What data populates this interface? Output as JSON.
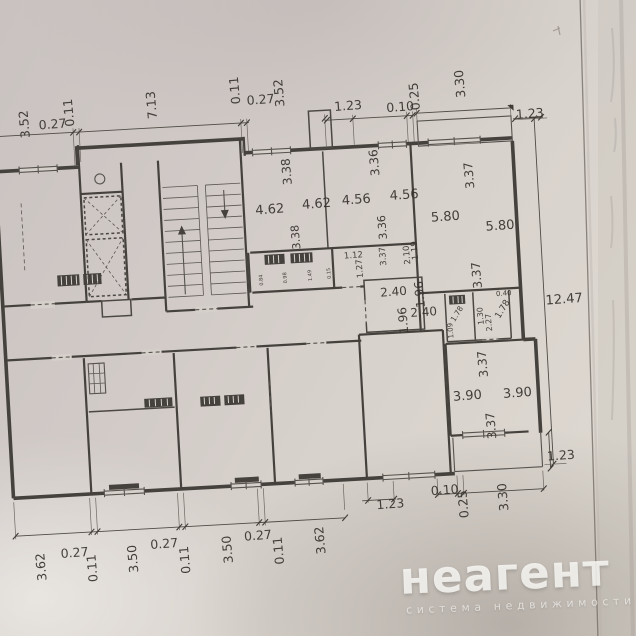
{
  "watermark": {
    "brand": "неагент",
    "tagline": "система недвижимости"
  },
  "colors": {
    "paper_top": "#c9c2c0",
    "paper_mid": "#d8d2cc",
    "paper_bottom": "#dfdad2",
    "ink": "#45413c",
    "label_ink": "#37332e",
    "watermark": "#fbfaf7",
    "paper_edge_line": "#756e68"
  },
  "plan": {
    "dimension_labels": [
      {
        "t": "3.52",
        "x": 40,
        "y": 119,
        "r": "v",
        "s": 12.5
      },
      {
        "t": "0.27",
        "x": 64,
        "y": 125,
        "r": "h",
        "s": 12.5
      },
      {
        "t": "0.11",
        "x": 85,
        "y": 110,
        "r": "v",
        "s": 12.5
      },
      {
        "t": "7.13",
        "x": 168,
        "y": 107,
        "r": "v",
        "s": 12.5
      },
      {
        "t": "0.11",
        "x": 252,
        "y": 97,
        "r": "v",
        "s": 12.5
      },
      {
        "t": "0.27",
        "x": 273,
        "y": 112,
        "r": "h",
        "s": 12.5
      },
      {
        "t": "3.52",
        "x": 296,
        "y": 102,
        "r": "v",
        "s": 12.5
      },
      {
        "t": "1.23",
        "x": 360,
        "y": 123,
        "r": "h",
        "s": 12.5
      },
      {
        "t": "0.10",
        "x": 412,
        "y": 127,
        "r": "h",
        "s": 12.5
      },
      {
        "t": "0.25",
        "x": 431,
        "y": 113,
        "r": "v",
        "s": 12.5
      },
      {
        "t": "3.30",
        "x": 477,
        "y": 103,
        "r": "v",
        "s": 12.5
      },
      {
        "t": "1.23",
        "x": 541,
        "y": 141,
        "r": "h",
        "s": 12.5
      },
      {
        "t": "12.47",
        "x": 565,
        "y": 328,
        "r": "h",
        "s": 13
      },
      {
        "t": "3.38",
        "x": 299,
        "y": 181,
        "r": "v",
        "s": 12
      },
      {
        "t": "4.62",
        "x": 276,
        "y": 222,
        "r": "h",
        "s": 13
      },
      {
        "t": "4.62",
        "x": 323,
        "y": 219,
        "r": "h",
        "s": 13
      },
      {
        "t": "3.38",
        "x": 304,
        "y": 247,
        "r": "v",
        "s": 11
      },
      {
        "t": "3.36",
        "x": 387,
        "y": 177,
        "r": "v",
        "s": 12
      },
      {
        "t": "4.56",
        "x": 363,
        "y": 217,
        "r": "h",
        "s": 13
      },
      {
        "t": "4.56",
        "x": 411,
        "y": 215,
        "r": "h",
        "s": 13
      },
      {
        "t": "3.36",
        "x": 391,
        "y": 242,
        "r": "v",
        "s": 11
      },
      {
        "t": "3.37",
        "x": 481,
        "y": 195,
        "r": "v",
        "s": 12
      },
      {
        "t": "5.80",
        "x": 451,
        "y": 239,
        "r": "h",
        "s": 13
      },
      {
        "t": "5.80",
        "x": 505,
        "y": 251,
        "r": "h",
        "s": 13
      },
      {
        "t": "3.37",
        "x": 483,
        "y": 295,
        "r": "v",
        "s": 12
      },
      {
        "t": "3.37",
        "x": 389,
        "y": 271,
        "r": "v",
        "s": 8.5
      },
      {
        "t": "1.12",
        "x": 357,
        "y": 271,
        "r": "h",
        "s": 8.5
      },
      {
        "t": "1.27",
        "x": 365,
        "y": 282,
        "r": "v",
        "s": 8.5
      },
      {
        "t": "2.10",
        "x": 413,
        "y": 271,
        "r": "v",
        "s": 8.5
      },
      {
        "t": "1.19",
        "x": 421,
        "y": 267,
        "r": "v",
        "s": 8.5
      },
      {
        "t": "2.40",
        "x": 395,
        "y": 311,
        "r": "h",
        "s": 12
      },
      {
        "t": "1.96",
        "x": 425,
        "y": 311,
        "r": "v",
        "s": 12
      },
      {
        "t": "1.96",
        "x": 407,
        "y": 336,
        "r": "v",
        "s": 12
      },
      {
        "t": "2.40",
        "x": 424,
        "y": 333,
        "r": "h",
        "s": 12
      },
      {
        "t": "0.84",
        "x": 265,
        "y": 288,
        "r": "v",
        "s": 5
      },
      {
        "t": "0.98",
        "x": 289,
        "y": 287,
        "r": "v",
        "s": 5
      },
      {
        "t": "1.49",
        "x": 314,
        "y": 286,
        "r": "v",
        "s": 5
      },
      {
        "t": "0.15",
        "x": 333,
        "y": 285,
        "r": "v",
        "s": 5
      },
      {
        "t": "1.78",
        "x": 459,
        "y": 334,
        "r": "d",
        "s": 7.5
      },
      {
        "t": "1.09",
        "x": 452,
        "y": 349,
        "r": "v",
        "s": 7
      },
      {
        "t": "1.30",
        "x": 483,
        "y": 336,
        "r": "v",
        "s": 8
      },
      {
        "t": "2.27",
        "x": 491,
        "y": 343,
        "r": "v",
        "s": 8
      },
      {
        "t": "1.78",
        "x": 505,
        "y": 332,
        "r": "d",
        "s": 9
      },
      {
        "t": "0.40",
        "x": 505,
        "y": 317,
        "r": "h",
        "s": 7
      },
      {
        "t": "3.37",
        "x": 484,
        "y": 384,
        "r": "v",
        "s": 12
      },
      {
        "t": "3.90",
        "x": 463,
        "y": 419,
        "r": "h",
        "s": 13
      },
      {
        "t": "3.90",
        "x": 513,
        "y": 419,
        "r": "h",
        "s": 13
      },
      {
        "t": "3.37",
        "x": 489,
        "y": 446,
        "r": "v",
        "s": 12
      },
      {
        "t": "1.23",
        "x": 553,
        "y": 484,
        "r": "h",
        "s": 12.5
      },
      {
        "t": "0.10",
        "x": 435,
        "y": 512,
        "r": "h",
        "s": 12.5
      },
      {
        "t": "0.25",
        "x": 457,
        "y": 523,
        "r": "v",
        "s": 12.5
      },
      {
        "t": "3.30",
        "x": 497,
        "y": 518,
        "r": "v",
        "s": 12.5
      },
      {
        "t": "1.23",
        "x": 380,
        "y": 523,
        "r": "h",
        "s": 12.5
      },
      {
        "t": "3.62",
        "x": 32,
        "y": 562,
        "r": "v",
        "s": 12.5
      },
      {
        "t": "0.27",
        "x": 62,
        "y": 554,
        "r": "h",
        "s": 12.5
      },
      {
        "t": "0.11",
        "x": 83,
        "y": 566,
        "r": "v",
        "s": 12.5
      },
      {
        "t": "3.50",
        "x": 124,
        "y": 559,
        "r": "v",
        "s": 12.5
      },
      {
        "t": "0.27",
        "x": 152,
        "y": 550,
        "r": "h",
        "s": 12.5
      },
      {
        "t": "0.11",
        "x": 176,
        "y": 563,
        "r": "v",
        "s": 12.5
      },
      {
        "t": "3.50",
        "x": 219,
        "y": 555,
        "r": "v",
        "s": 12.5
      },
      {
        "t": "0.27",
        "x": 246,
        "y": 547,
        "r": "h",
        "s": 12.5
      },
      {
        "t": "0.11",
        "x": 270,
        "y": 559,
        "r": "v",
        "s": 12.5
      },
      {
        "t": "3.62",
        "x": 312,
        "y": 551,
        "r": "v",
        "s": 12.5
      }
    ]
  }
}
